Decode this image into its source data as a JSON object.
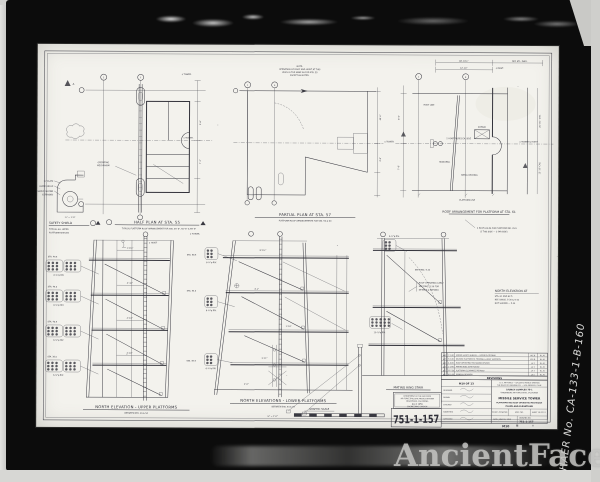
{
  "frame": {
    "haer_label": "HAER No. CA-133-1-B-160",
    "watermark": "AncientFaces"
  },
  "plans": {
    "half": {
      "title": "HALF PLAN AT STA. 55",
      "sub": "TYPICAL PLATFORM ROOF ARRANGEMENT FOR STA. 45'-6\", 50'-6\" & 55'-6\"",
      "cl1": "¢ TOWER.",
      "cl2": "¢ TOWER.",
      "dim1": "9'-6\"",
      "dim2": "7'-2\"",
      "note1": "OPERATING",
      "note2": "MECHANISM",
      "b1": "2",
      "b2": "7",
      "mark": "A"
    },
    "safety": {
      "title": "SAFETY SHIELD",
      "sub1": "TYPICAL ALL UPPER",
      "sub2": "PLATFORM SHIELDS",
      "scale": "¾\" = 1'-0\"",
      "n1": "⅜\" PLATE",
      "n2": "GUIDE ANGLE",
      "n3": "SHIELD SHOWN",
      "n4": "EXTENDED"
    },
    "partial": {
      "title": "PARTIAL PLAN AT STA. 57",
      "sub": "PLATFORM ROOF ARRANGEMENTS FOR STA. 59 & 60",
      "note1": "NOTE:",
      "note2": "OPERATION OF ROOF AND HOIST AT THIS",
      "note3": "LEVEL IS THE SAME AS FOR STA. 55",
      "note4": "EXCEPT AS NOTED.",
      "cl": "¢ TOWER.",
      "dim1": "40'-0\"",
      "dim2": "4'-6\"",
      "b1": "1",
      "b2": "9"
    },
    "roof": {
      "title": "ROOF ARRANGEMENT FOR PLATFORM AT STA. 61",
      "dimA": "48'-10½\"",
      "dimB": "12'-10\"",
      "dimC": "REF. STL. DWG.",
      "clm": "¢ MAST.",
      "cl": "¢ TOWER & HOIST",
      "dimL1": "8'-0\"",
      "dimL2": "7'-6\"",
      "dimR1": "20'-3½\" CRS.",
      "dimR2": "13'-10\" CRS.",
      "n_roof": "ROOF LINE",
      "n_mono": "MONORAIL",
      "n_deck": "METAL DECKING",
      "n_sheave": "SHEAVE",
      "n_hoist": "2 HOIST ROPES EA. SIDE",
      "n_plat": "PLATFORM LINE",
      "bolt1": "4 BOLT HOLES FOR PLATFORM NO. 29.5",
      "bolt2": "(2 THIS SIDE — 2 FAR SIDE)",
      "b1": "1",
      "b2": "8"
    }
  },
  "elevs": {
    "left": {
      "title": "NORTH ELEVATION - UPPER PLATFORMS",
      "sub": "BETWEEN STA. 29 & 54",
      "sta1": "STA. 49.5",
      "sta2": "STA. 45.0",
      "sta3": "STA. 40.5",
      "sta4": "STA. 36.0",
      "d1": "1'-4¾\"",
      "d2": "4'-10\"",
      "d3": "4'-10\"",
      "d4": "4'-10\"",
      "hoist": "¢ HOIST",
      "riv": "6-⅞\"φ RIV."
    },
    "center": {
      "title": "NORTH ELEVATIONS - LOWER PLATFORMS",
      "sub": "BETWEEN STA. 54 & 57",
      "sta1": "STA. 58.5",
      "sta2": "STA. 54.0",
      "sta3": "STA. 49.5",
      "cl": "¢ TOWER.",
      "d1": "8'-4½\"",
      "d2": "4'-1\"",
      "d3": "1'-10\"",
      "d4": "3'-11\"",
      "d5": "2'-0\"",
      "riv": "6-¾\"φ RIV."
    },
    "right": {
      "l1": "NORTH ELEVATION AT",
      "l2": "STA. 61 AND 62.5",
      "l3": "REF. DWGS. 5-30 & 5-32",
      "l4": "NOT SHOWN — 5-34",
      "stair": "MATING RING STAIR",
      "see": "SEE DWG. 5-33",
      "note1": "ROOF OPERATING CABLE",
      "note2": "SEE DWG. 5-30 FOR",
      "note3": "DETAILS & REEVING",
      "riv1": "6-¾\"φ RIV.",
      "riv2": "10-⅞\"φ RIV."
    }
  },
  "rev": {
    "header": "REVISIONS",
    "rows": [
      {
        "n": "▲6",
        "d": "7-1-60",
        "t": "ADDED SAFETY SHIELDS — UPPER PLATFORMS",
        "b": "W.E.B.",
        "a": "R.L.M."
      },
      {
        "n": "▲5",
        "d": "6-2-60",
        "t": "REVISED PLATFORM 61 FRAMING & HOIST SUPPORTS",
        "b": "W.E.B.",
        "a": "R.L.M."
      },
      {
        "n": "▲4",
        "d": "4-8-60",
        "t": "ROOF OPERATING MECHANISM REVISED",
        "b": "J.A.T.",
        "a": "R.L.M."
      },
      {
        "n": "▲3",
        "d": "2-1-60",
        "t": "MATING RING STAIR ADDED",
        "b": "J.A.T.",
        "a": "R.L.M."
      },
      {
        "n": "▲2",
        "d": "12-7-59",
        "t": "PLATFORM CLEARANCES REVISED",
        "b": "J.A.T.",
        "a": "R.L.M."
      },
      {
        "n": "▲1",
        "d": "10-5-59",
        "t": "GENERAL REVISION",
        "b": "J.A.T.",
        "a": "R.L.M."
      }
    ]
  },
  "tb": {
    "sheet_of": "M10 OF 13",
    "h1": "U. S. AIR FORCE — BALLISTIC MISSILE DIVISION",
    "h2": "THE RALPH M. PARSONS CO. — LOS ANGELES, CALIF.",
    "c1": "LAUNCH COMPLEX 75-1",
    "c2": "VANDENBERG AIR FORCE BASE, CALIFORNIA",
    "t1": "MISSILE SERVICE TOWER",
    "t2": "PLATFORMS AND ROOF OPERATING MECHANISM",
    "t3": "PLANS AND ELEVATIONS",
    "s1": "SCALE: AS NOTED",
    "s2": "SPEC. NO.",
    "s3": "SHEET 10 OF 13",
    "s4": "DATE: JUNE 30, 1959",
    "s5": "DRAWING NO.",
    "s6": "751-1-157",
    "r1": "DESIGNED",
    "r2": "DRAWN",
    "r3": "CHECKED",
    "r4": "SUBMITTED",
    "r5": "APPROVED",
    "code": "M10"
  },
  "stamp": {
    "l1": "DEPARTMENT OF THE AIR FORCE",
    "l2": "AIR FORCE BALLISTIC MISSILE DIVISION",
    "l3": "INGLEWOOD, CALIFORNIA",
    "l4": "JUL 6 1959",
    "l5": "ENGINEERING DIVISION"
  },
  "num": {
    "big": "751-1-157"
  },
  "scalebar": {
    "title": "GRAPHIC SCALE",
    "unit": "⅛\" = 1'-0\""
  }
}
